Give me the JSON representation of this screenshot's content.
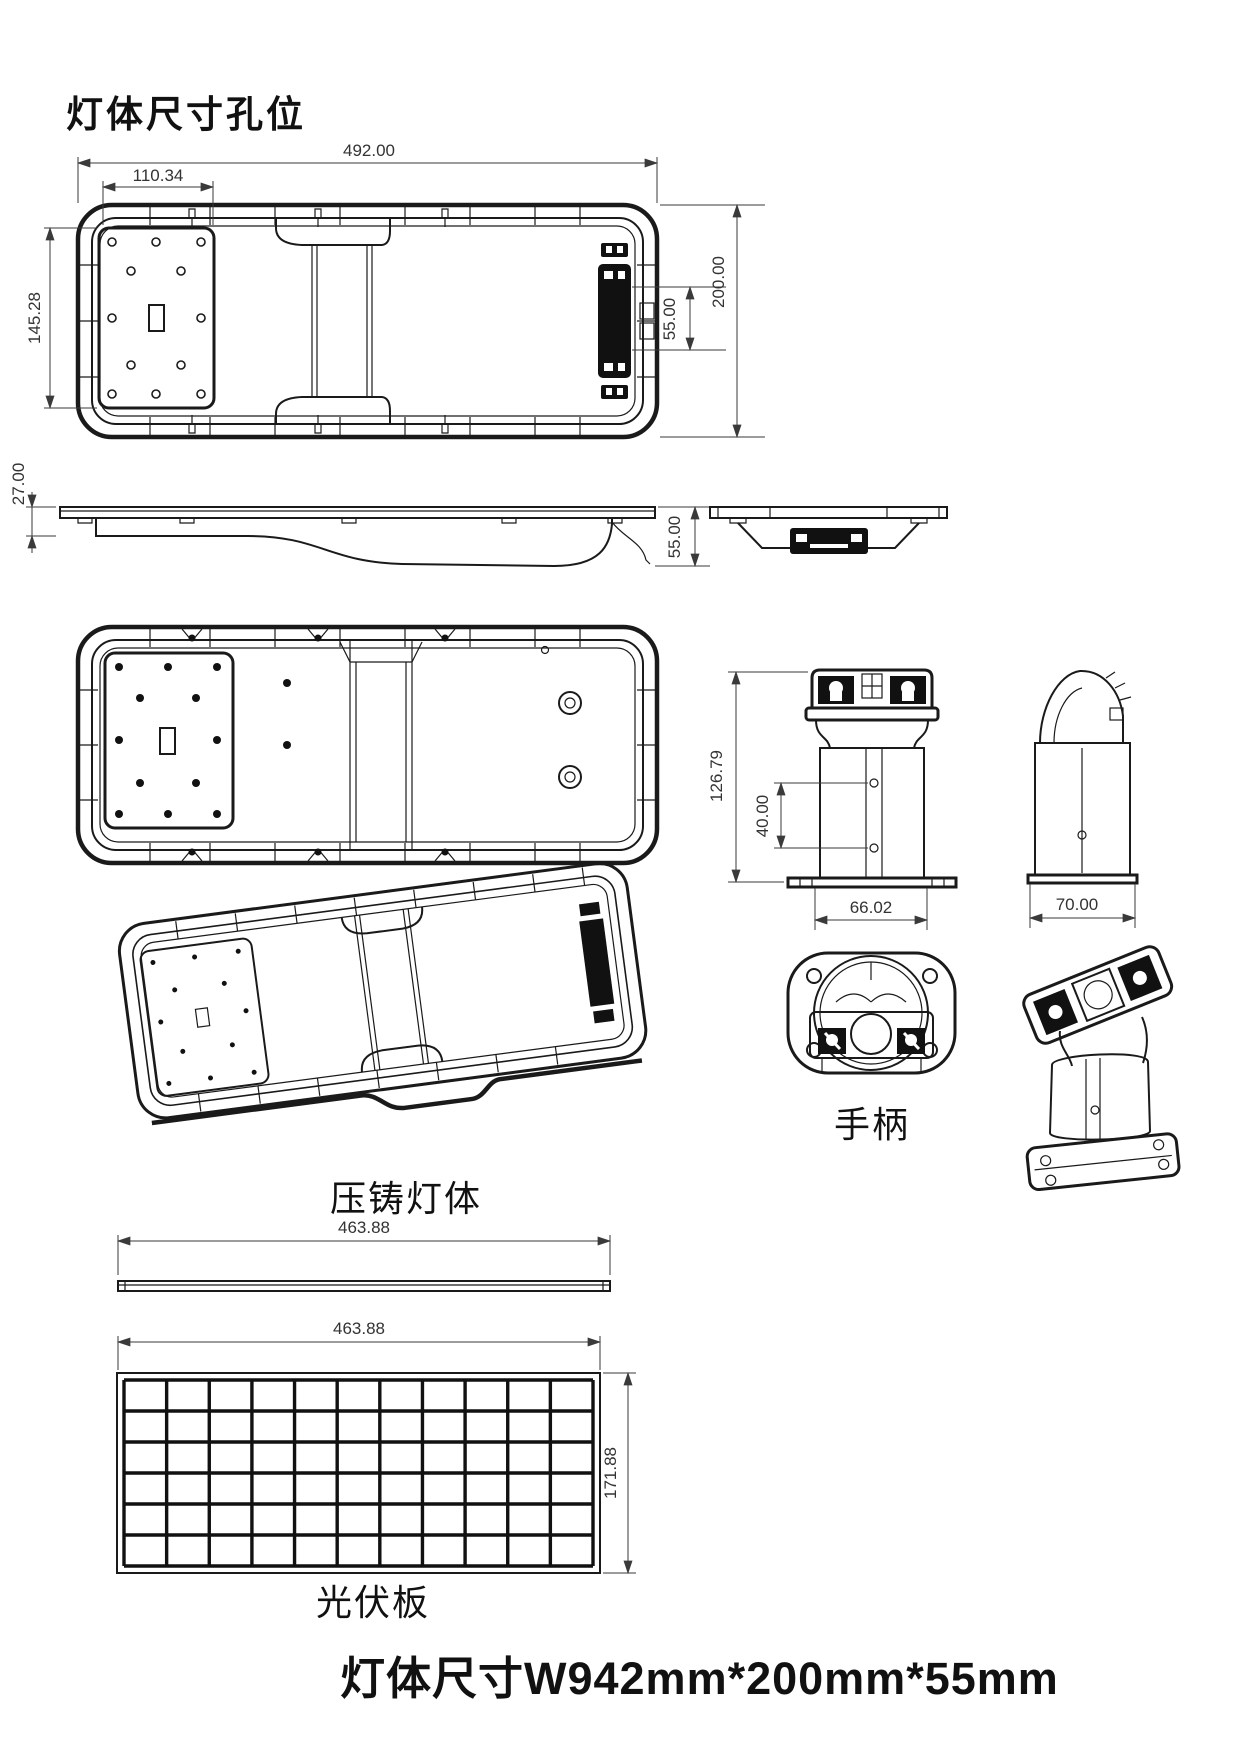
{
  "page": {
    "title": "灯体尺寸孔位",
    "footer": "灯体尺寸W942mm*200mm*55mm"
  },
  "views": {
    "top_view": {
      "dims": {
        "overall_width": "492.00",
        "plate_width": "110.34",
        "plate_height": "145.28",
        "connector_height": "55.00",
        "overall_height": "200.00"
      }
    },
    "side_view": {
      "dims": {
        "rim_thickness": "27.00",
        "body_depth": "55.00"
      }
    },
    "bracket_front": {
      "dims": {
        "height": "126.79",
        "hole_spacing": "40.00",
        "base_width": "66.02"
      }
    },
    "bracket_side": {
      "dims": {
        "base_width": "70.00"
      }
    },
    "cast_body": {
      "label": "压铸灯体"
    },
    "handle": {
      "label": "手柄"
    },
    "solar_bar": {
      "dims": {
        "width": "463.88"
      }
    },
    "solar_panel": {
      "label": "光伏板",
      "dims": {
        "width": "463.88",
        "height": "171.88"
      },
      "grid": {
        "cols": 11,
        "rows": 6
      }
    }
  }
}
